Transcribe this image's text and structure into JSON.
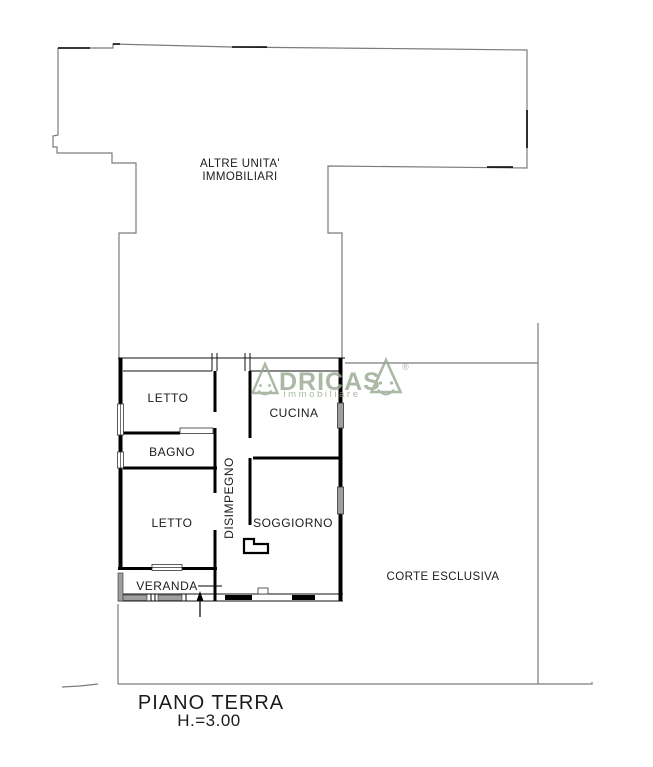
{
  "plan": {
    "upper_unit": {
      "line1": "ALTRE UNITA'",
      "line2": "IMMOBILIARI"
    },
    "courtyard_label": "CORTE ESCLUSIVA",
    "rooms": {
      "letto1": "LETTO",
      "cucina": "CUCINA",
      "bagno": "BAGNO",
      "disimpegno": "DISIMPEGNO",
      "letto2": "LETTO",
      "soggiorno": "SOGGIORNO",
      "veranda": "VERANDA"
    },
    "title": "PIANO TERRA",
    "height_note": "H.=3.00"
  },
  "logo": {
    "brand": "ADRICASA",
    "letters": "DRICAS",
    "registered": "®",
    "tagline": "immobiliare",
    "color": "#98a992"
  },
  "colors": {
    "outline": "#7c7c7c",
    "walls": "#000000",
    "glazing": "#9f9f9f",
    "text": "#1b1b1b"
  }
}
